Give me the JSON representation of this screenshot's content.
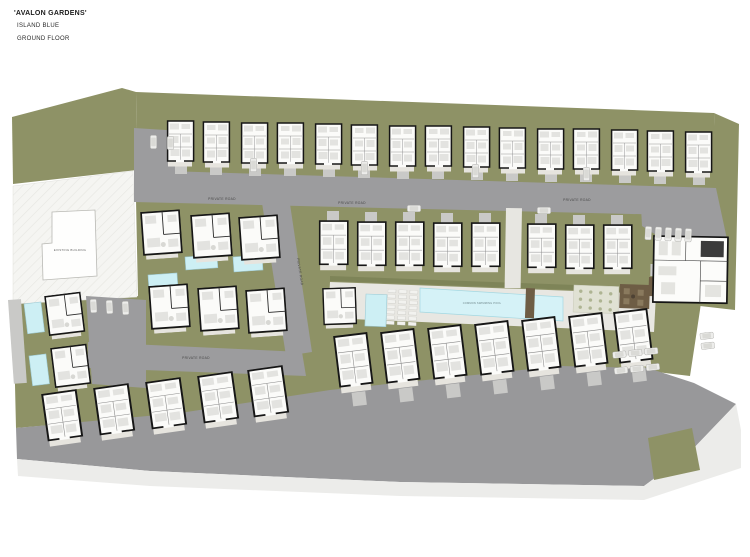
{
  "title": {
    "line1": "'AVALON GARDENS'",
    "line2": "ISLAND BLUE",
    "line3": "GROUND FLOOR"
  },
  "labels": {
    "private_road": "PRIVATE ROAD",
    "existing_building": "EXISTING BUILDING",
    "common_pool": "COMMON SWIMMING POOL"
  },
  "colors": {
    "landscape_green": "#8E9266",
    "road_gray": "#9C9C9E",
    "driveway_gray": "#C9C9C7",
    "deck_pale": "#E8E7E2",
    "pool_blue": "#CDEFF4",
    "deck_brown": "#6E5D45",
    "building_fill": "#FBFBF9",
    "wall_black": "#161616"
  }
}
